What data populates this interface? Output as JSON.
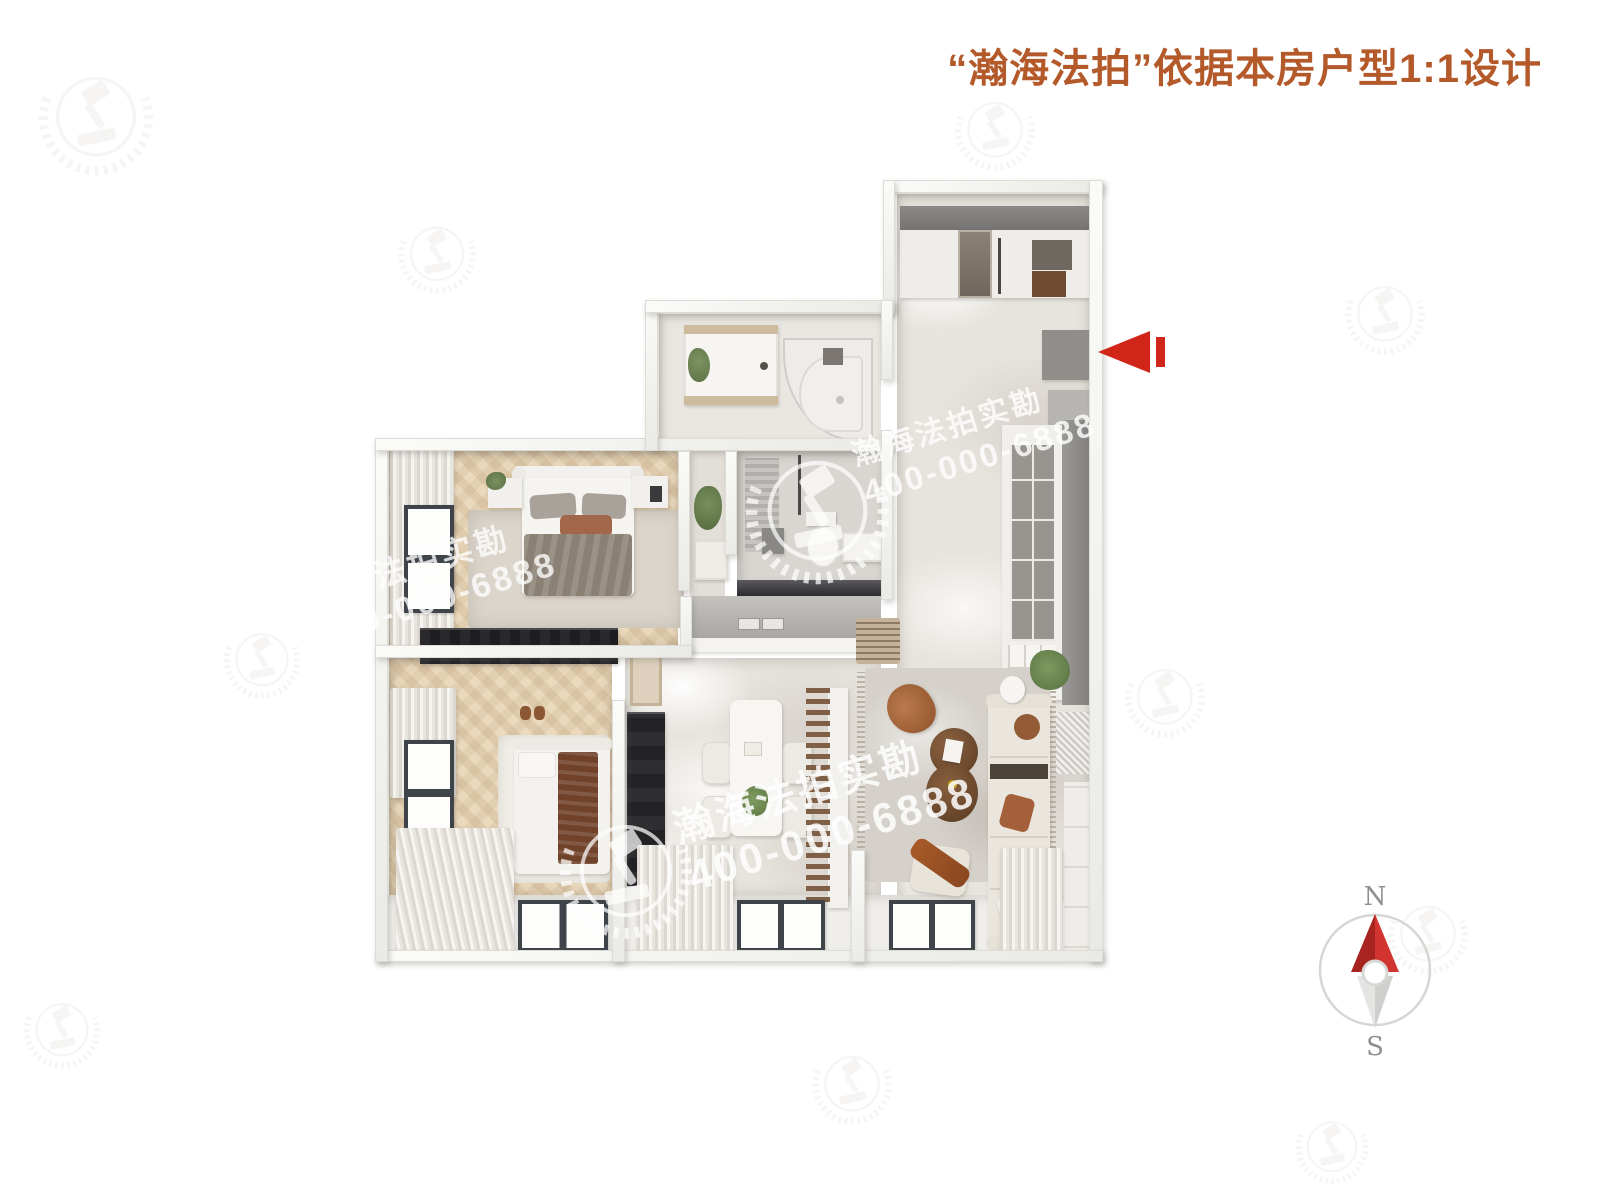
{
  "header": {
    "title": "“瀚海法拍”依据本房户型1:1设计",
    "color": "#b3592a"
  },
  "watermark": {
    "brand": "瀚海法拍实勘",
    "phone": "400-000-6888"
  },
  "compass": {
    "north": "N",
    "south": "S",
    "needle_red": "#c5251f",
    "needle_gray": "#d9d9d7"
  },
  "entrance_arrow": {
    "color": "#d2251a",
    "direction": "left"
  },
  "floorplan_rooms": [
    "entry-foyer",
    "hallway",
    "bathroom",
    "toilet",
    "master-bedroom",
    "second-bedroom",
    "dining-area",
    "kitchen-niche",
    "living-room",
    "window-band"
  ]
}
